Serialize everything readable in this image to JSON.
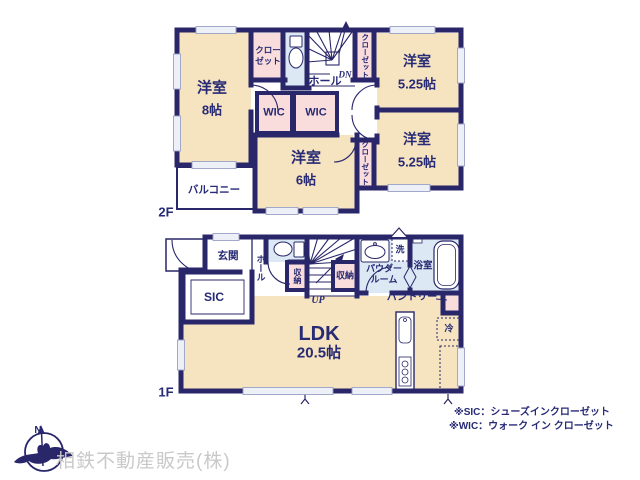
{
  "colors": {
    "wall": "#29276a",
    "label_text": "#272a74",
    "room_fill": "#f6e3c0",
    "closet_fill": "#f9dcdc",
    "wet_area_fill": "#dce8f3",
    "window_fill": "#eef0f8",
    "company_text": "#c9c9c9"
  },
  "company": "相鉄不動産販売(株)",
  "compass_n": "N",
  "notes": {
    "sic": "※SIC：シューズインクローゼット",
    "wic": "※WIC：ウォーク イン クローゼット"
  },
  "f2": {
    "floor_label": "2F",
    "room8_name": "洋室",
    "room8_size": "8帖",
    "closet_nw_line1": "クロー",
    "closet_nw_line2": "ゼット",
    "hall": "ホール",
    "stairs_dn": "DN",
    "closet_east_top": "クローゼット",
    "room525a_name": "洋室",
    "room525a_size": "5.25帖",
    "wic_left": "WIC",
    "wic_right": "WIC",
    "room6_name": "洋室",
    "room6_size": "6帖",
    "closet_east_bottom": "クローゼット",
    "room525b_name": "洋室",
    "room525b_size": "5.25帖",
    "balcony": "バルコニー"
  },
  "f1": {
    "floor_label": "1F",
    "entrance": "玄関",
    "hall": "ホール",
    "sic": "SIC",
    "storage_left": "収納",
    "storage_right": "収納",
    "stairs_up": "UP",
    "powder_line1": "パウダー",
    "powder_line2": "ルーム",
    "laundry": "洗",
    "bath": "浴室",
    "pantry": "パントリー",
    "fridge": "冷",
    "ldk_name": "LDK",
    "ldk_size": "20.5帖"
  }
}
